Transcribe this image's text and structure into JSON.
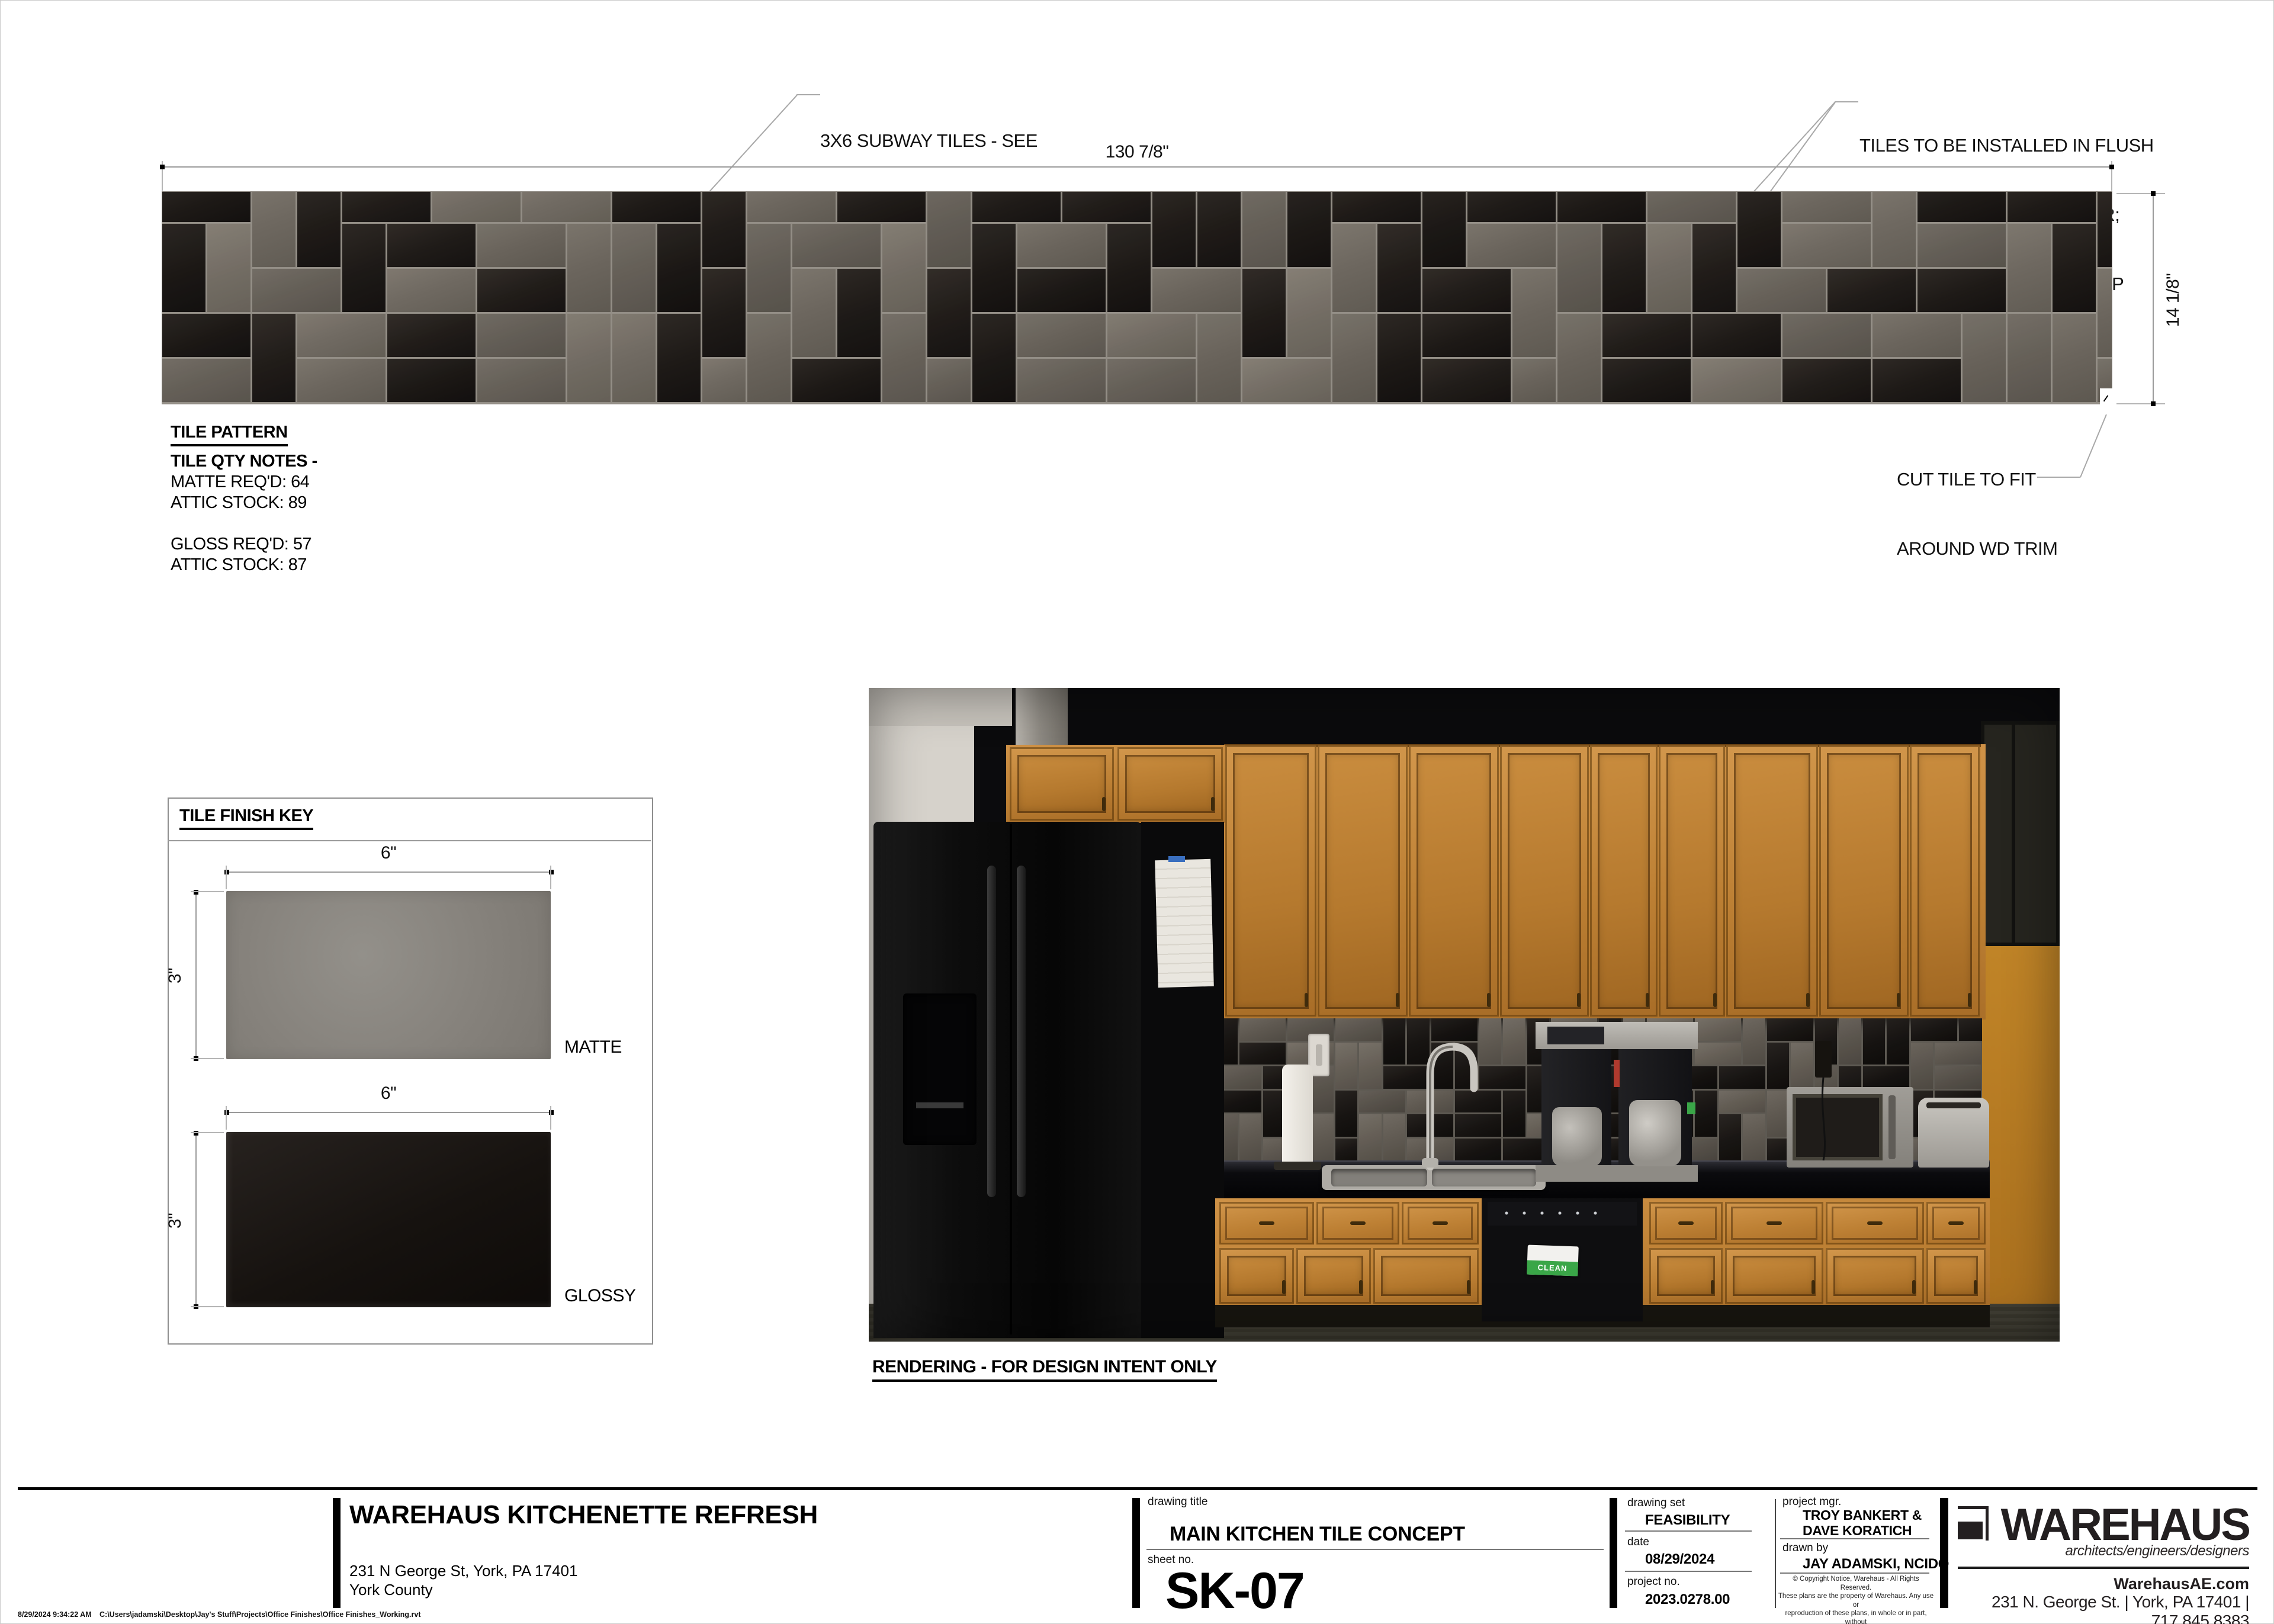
{
  "annotations": {
    "subway": [
      "3X6 SUBWAY TILES - SEE",
      "KEY FOR FINISHES"
    ],
    "flush": [
      "TILES TO BE INSTALLED IN FLUSH",
      "ALIGNMENT TO EACH OTHER;",
      "GROUT BEVELED JOINTS, TYP"
    ],
    "cut": [
      "CUT TILE TO FIT",
      "AROUND WD TRIM"
    ]
  },
  "dimensions": {
    "strip_width": "130 7/8\"",
    "strip_height": "14 1/8\"",
    "tile_width_matte": "6\"",
    "tile_height_matte": "3\"",
    "tile_width_glossy": "6\"",
    "tile_height_glossy": "3\""
  },
  "tile_pattern": {
    "heading": "TILE PATTERN",
    "notes_title": "TILE QTY NOTES -",
    "matte_req": "MATTE REQ'D: 64",
    "matte_stock": "ATTIC STOCK: 89",
    "gloss_req": "GLOSS REQ'D: 57",
    "gloss_stock": "ATTIC STOCK: 87",
    "strip": {
      "seed": 20240829,
      "rows": 5,
      "cols": 44,
      "matte_ratio": 0.52
    }
  },
  "finish_key": {
    "heading": "TILE FINISH KEY",
    "matte_label": "MATTE",
    "glossy_label": "GLOSSY"
  },
  "rendering": {
    "caption": "RENDERING - FOR DESIGN INTENT ONLY",
    "clean_tag": "CLEAN",
    "backsplash": {
      "seed": 4117,
      "rows": 6,
      "cols": 33,
      "matte_ratio": 0.5
    }
  },
  "title_block": {
    "labels": {
      "drawing_title": "drawing title",
      "sheet_no": "sheet no.",
      "drawing_set": "drawing set",
      "date": "date",
      "project_no": "project no.",
      "project_mgr": "project mgr.",
      "drawn_by": "drawn by"
    },
    "project_title": "WAREHAUS KITCHENETTE REFRESH",
    "address1": "231 N George St, York, PA  17401",
    "address2": "York County",
    "drawing_title": "MAIN KITCHEN TILE CONCEPT",
    "sheet_no": "SK-07",
    "drawing_set": "FEASIBILITY",
    "date": "08/29/2024",
    "project_no": "2023.0278.00",
    "project_mgr_line1": "TROY BANKERT &",
    "project_mgr_line2": "DAVE KORATICH",
    "drawn_by": "JAY ADAMSKI, NCIDQ",
    "copyright": [
      "© Copyright Notice, Warehaus - All Rights Reserved.",
      "These plans are the property of Warehaus. Any use or",
      "reproduction of these plans, in whole or in part, without",
      "the written permission of Warehaus is forbidden."
    ]
  },
  "logo": {
    "name": "WAREHAUS",
    "tagline": "architects/engineers/designers",
    "website": "WarehausAE.com",
    "contact": "231 N. George St. | York, PA 17401 | 717.845.8383"
  },
  "footer": {
    "timestamp": "8/29/2024 9:34:22 AM",
    "file_path": "C:\\Users\\jadamski\\Desktop\\Jay's Stuff\\Projects\\Office Finishes\\Office Finishes_Working.rvt"
  }
}
